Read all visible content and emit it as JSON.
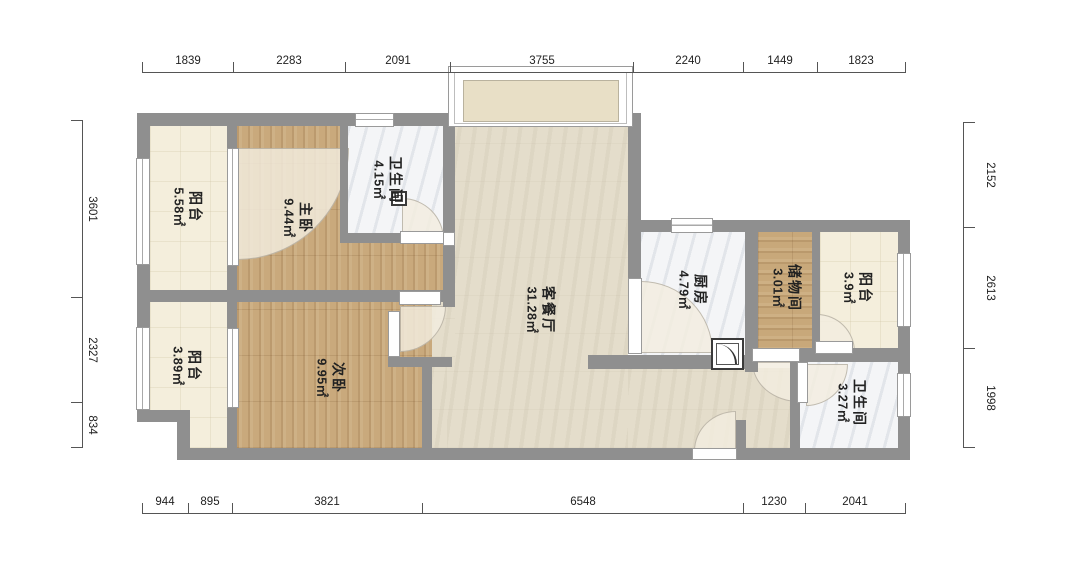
{
  "title": "户型图",
  "rooms": [
    {
      "id": "balcony-top-left",
      "name": "阳台",
      "area": "5.58㎡"
    },
    {
      "id": "master-bedroom",
      "name": "主卧",
      "area": "9.44㎡"
    },
    {
      "id": "bathroom-top",
      "name": "卫生间",
      "area": "4.15㎡"
    },
    {
      "id": "living-dining",
      "name": "客餐厅",
      "area": "31.28㎡"
    },
    {
      "id": "kitchen",
      "name": "厨房",
      "area": "4.79㎡"
    },
    {
      "id": "storage-room",
      "name": "储物间",
      "area": "3.01㎡"
    },
    {
      "id": "balcony-top-right",
      "name": "阳台",
      "area": "3.9㎡"
    },
    {
      "id": "balcony-bottom-left",
      "name": "阳台",
      "area": "3.89㎡"
    },
    {
      "id": "second-bedroom",
      "name": "次卧",
      "area": "9.95㎡"
    },
    {
      "id": "bathroom-bottom",
      "name": "卫生间",
      "area": "3.27㎡"
    }
  ],
  "dimensions": {
    "top": [
      "1839",
      "2283",
      "2091",
      "3755",
      "2240",
      "1449",
      "1823"
    ],
    "bottom": [
      "944",
      "895",
      "3821",
      "6548",
      "1230",
      "2041"
    ],
    "left": [
      "3601",
      "2327",
      "834"
    ],
    "right": [
      "2152",
      "2613",
      "1998"
    ]
  },
  "colors": {
    "wall": "#8f8f8f",
    "wood_floor": "#c9a97c",
    "tile_cream": "#f4eedc",
    "marble": "#f4f5f7",
    "living_floor": "#e4ddcb",
    "dimension_text": "#222222"
  }
}
